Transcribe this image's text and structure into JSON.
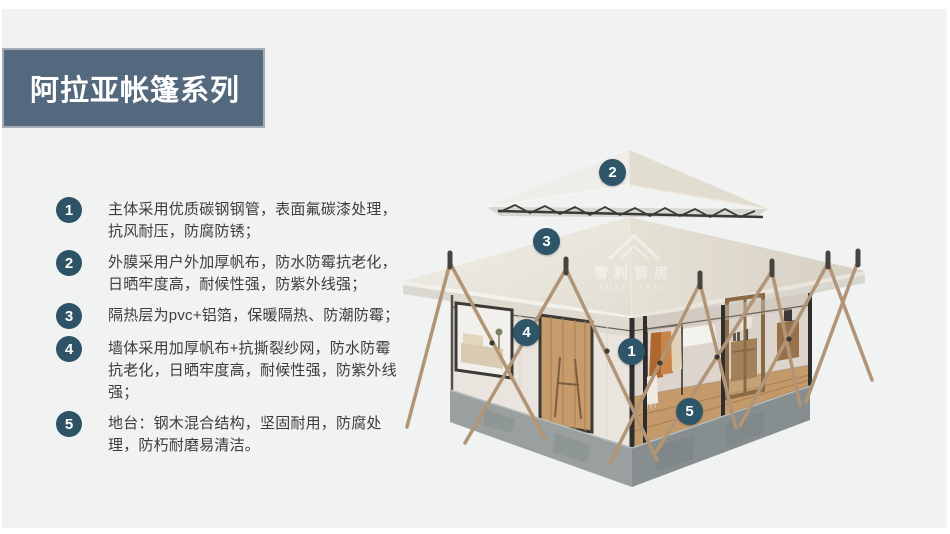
{
  "page": {
    "background_color": "#f1f2f2",
    "frame_color": "#ffffff"
  },
  "header": {
    "title": "阿拉亚帐篷系列",
    "banner_color": "#54697d",
    "title_color": "#ffffff"
  },
  "features": [
    {
      "num": "1",
      "text": "主体采用优质碳钢钢管，表面氟碳漆处理，抗风耐压，防腐防锈；"
    },
    {
      "num": "2",
      "text": "外膜采用户外加厚帆布，防水防霉抗老化，日晒牢度高，耐候性强，防紫外线强；"
    },
    {
      "num": "3",
      "text": "隔热层为pvc+铝箔，保暖隔热、防潮防霉；"
    },
    {
      "num": "4",
      "text": "墙体采用加厚帆布+抗撕裂纱网，防水防霉抗老化，日晒牢度高，耐候性强，防紫外线强；"
    },
    {
      "num": "5",
      "text": "地台：钢木混合结构，坚固耐用，防腐处理，防朽耐磨易清洁。"
    }
  ],
  "colors": {
    "accent_circle": "#2e5266",
    "tent_badge": "#2e5568",
    "body_text": "#3c3c3c",
    "roof_canvas": "#eceae3",
    "platform_concrete": "#8f9697"
  },
  "tent": {
    "badges": [
      {
        "num": "1"
      },
      {
        "num": "2"
      },
      {
        "num": "3"
      },
      {
        "num": "4"
      },
      {
        "num": "5"
      }
    ],
    "watermark": {
      "cn": "雪利营房",
      "en": "XUELI TENT"
    }
  }
}
